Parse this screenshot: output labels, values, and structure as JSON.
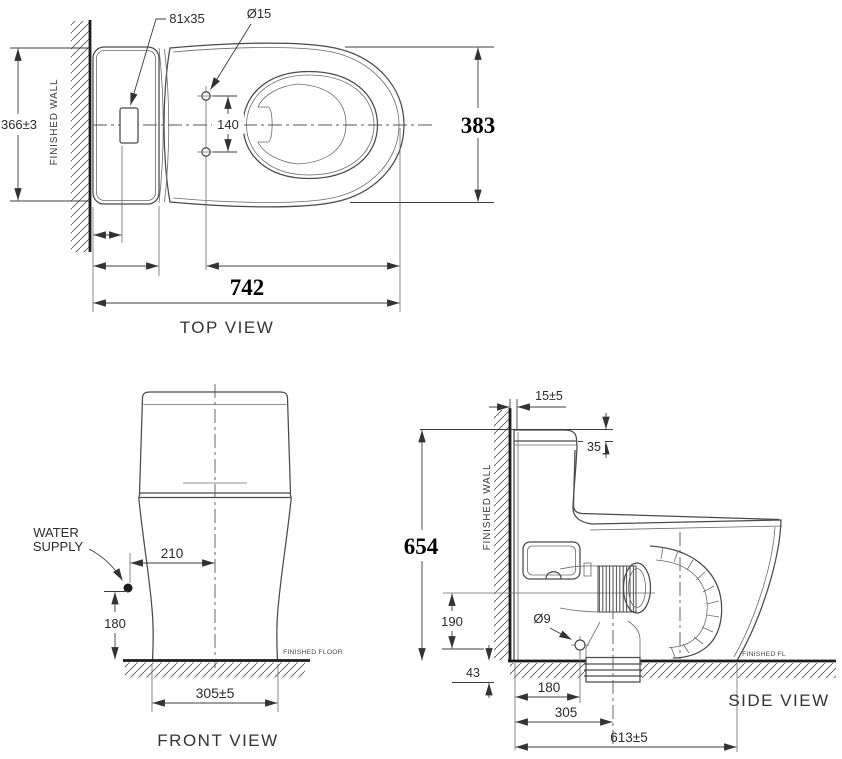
{
  "document": {
    "type": "technical-dimension-drawing",
    "subject": "one-piece toilet",
    "background_color": "#ffffff",
    "line_color": "#4a4a4a",
    "text_color": "#2b2b2b"
  },
  "views": {
    "top": {
      "title": "TOP VIEW",
      "wall_label": "FINISHED WALL",
      "dim_tank_width": "366±3",
      "dim_button": "81x35",
      "dim_hole_dia": "Ø15",
      "dim_hole_spacing": "140",
      "dim_overall_width": "383",
      "dim_overall_length": "742"
    },
    "front": {
      "title": "FRONT VIEW",
      "water_supply_line1": "WATER",
      "water_supply_line2": "SUPPLY",
      "floor_label": "FINISHED FLOOR",
      "dim_supply_offset": "210",
      "dim_supply_height": "180",
      "dim_base_width": "305±5"
    },
    "side": {
      "title": "SIDE VIEW",
      "wall_label": "FINISHED WALL",
      "floor_label": "FINISHED FL",
      "dim_wall_gap": "15±5",
      "dim_lid_height": "35",
      "dim_overall_height": "654",
      "dim_outlet_height": "190",
      "dim_hole_dia": "Ø9",
      "dim_floor_offset": "43",
      "dim_wall_to_bolt": "180",
      "dim_wall_to_outlet": "305",
      "dim_overall_depth": "613±5"
    }
  }
}
